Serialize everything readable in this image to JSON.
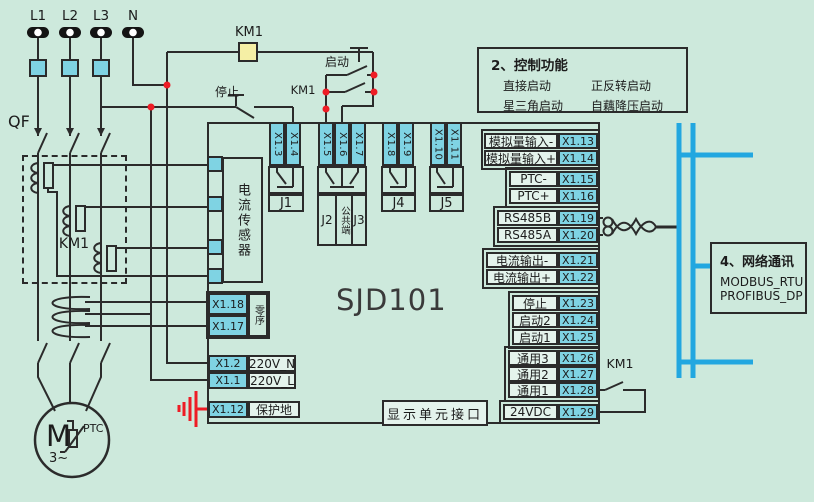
{
  "colors": {
    "background": "#cde9dc",
    "terminal_fill": "#7fd3e3",
    "bus_blue": "#22a7e0",
    "wire": "#2b2b2b",
    "highlight_red": "#ee1c25",
    "contactor_fill": "#f5efa5"
  },
  "supply": {
    "phases": [
      "L1",
      "L2",
      "L3",
      "N"
    ],
    "breaker": "QF"
  },
  "labels": {
    "km1": "KM1",
    "stop": "停止",
    "start": "启动"
  },
  "device": {
    "model": "SJD101",
    "current_sensor": "电流传感器",
    "zero_sequence": "零序",
    "display_interface": "显示单元接口"
  },
  "top_terminals": [
    "X1.3",
    "X1.4",
    "X1.5",
    "X1.6",
    "X1.7",
    "X1.8",
    "X1.9",
    "X1.10",
    "X1.11"
  ],
  "relays": {
    "j1": "J1",
    "j2": "J2",
    "common": "公共端",
    "j3": "J3",
    "j4": "J4",
    "j5": "J5"
  },
  "left_block": {
    "x118": "X1.18",
    "x117": "X1.17"
  },
  "power_rows": [
    {
      "id": "X1.2",
      "label": "220V_N"
    },
    {
      "id": "X1.1",
      "label": "220V_L"
    }
  ],
  "earth_row": {
    "id": "X1.12",
    "label": "保护地"
  },
  "right_rows": [
    {
      "label": "模拟量输入-",
      "id": "X1.13"
    },
    {
      "label": "模拟量输入+",
      "id": "X1.14"
    },
    {
      "label": "PTC-",
      "id": "X1.15"
    },
    {
      "label": "PTC+",
      "id": "X1.16"
    },
    {
      "label": "RS485B",
      "id": "X1.19"
    },
    {
      "label": "RS485A",
      "id": "X1.20"
    },
    {
      "label": "电流输出-",
      "id": "X1.21"
    },
    {
      "label": "电流输出+",
      "id": "X1.22"
    },
    {
      "label": "停止",
      "id": "X1.23"
    },
    {
      "label": "启动2",
      "id": "X1.24"
    },
    {
      "label": "启动1",
      "id": "X1.25"
    },
    {
      "label": "通用3",
      "id": "X1.26"
    },
    {
      "label": "通用2",
      "id": "X1.27"
    },
    {
      "label": "通用1",
      "id": "X1.28"
    },
    {
      "label": "24VDC",
      "id": "X1.29"
    }
  ],
  "motor": {
    "designation": "M",
    "phase": "3~",
    "sensor": "PTC"
  },
  "control_functions": {
    "title": "2、控制功能",
    "items": [
      "直接启动",
      "正反转启动",
      "星三角启动",
      "自藕降压启动"
    ]
  },
  "network": {
    "title": "4、网络通讯",
    "protocols": [
      "MODBUS_RTU",
      "PROFIBUS_DP"
    ]
  }
}
